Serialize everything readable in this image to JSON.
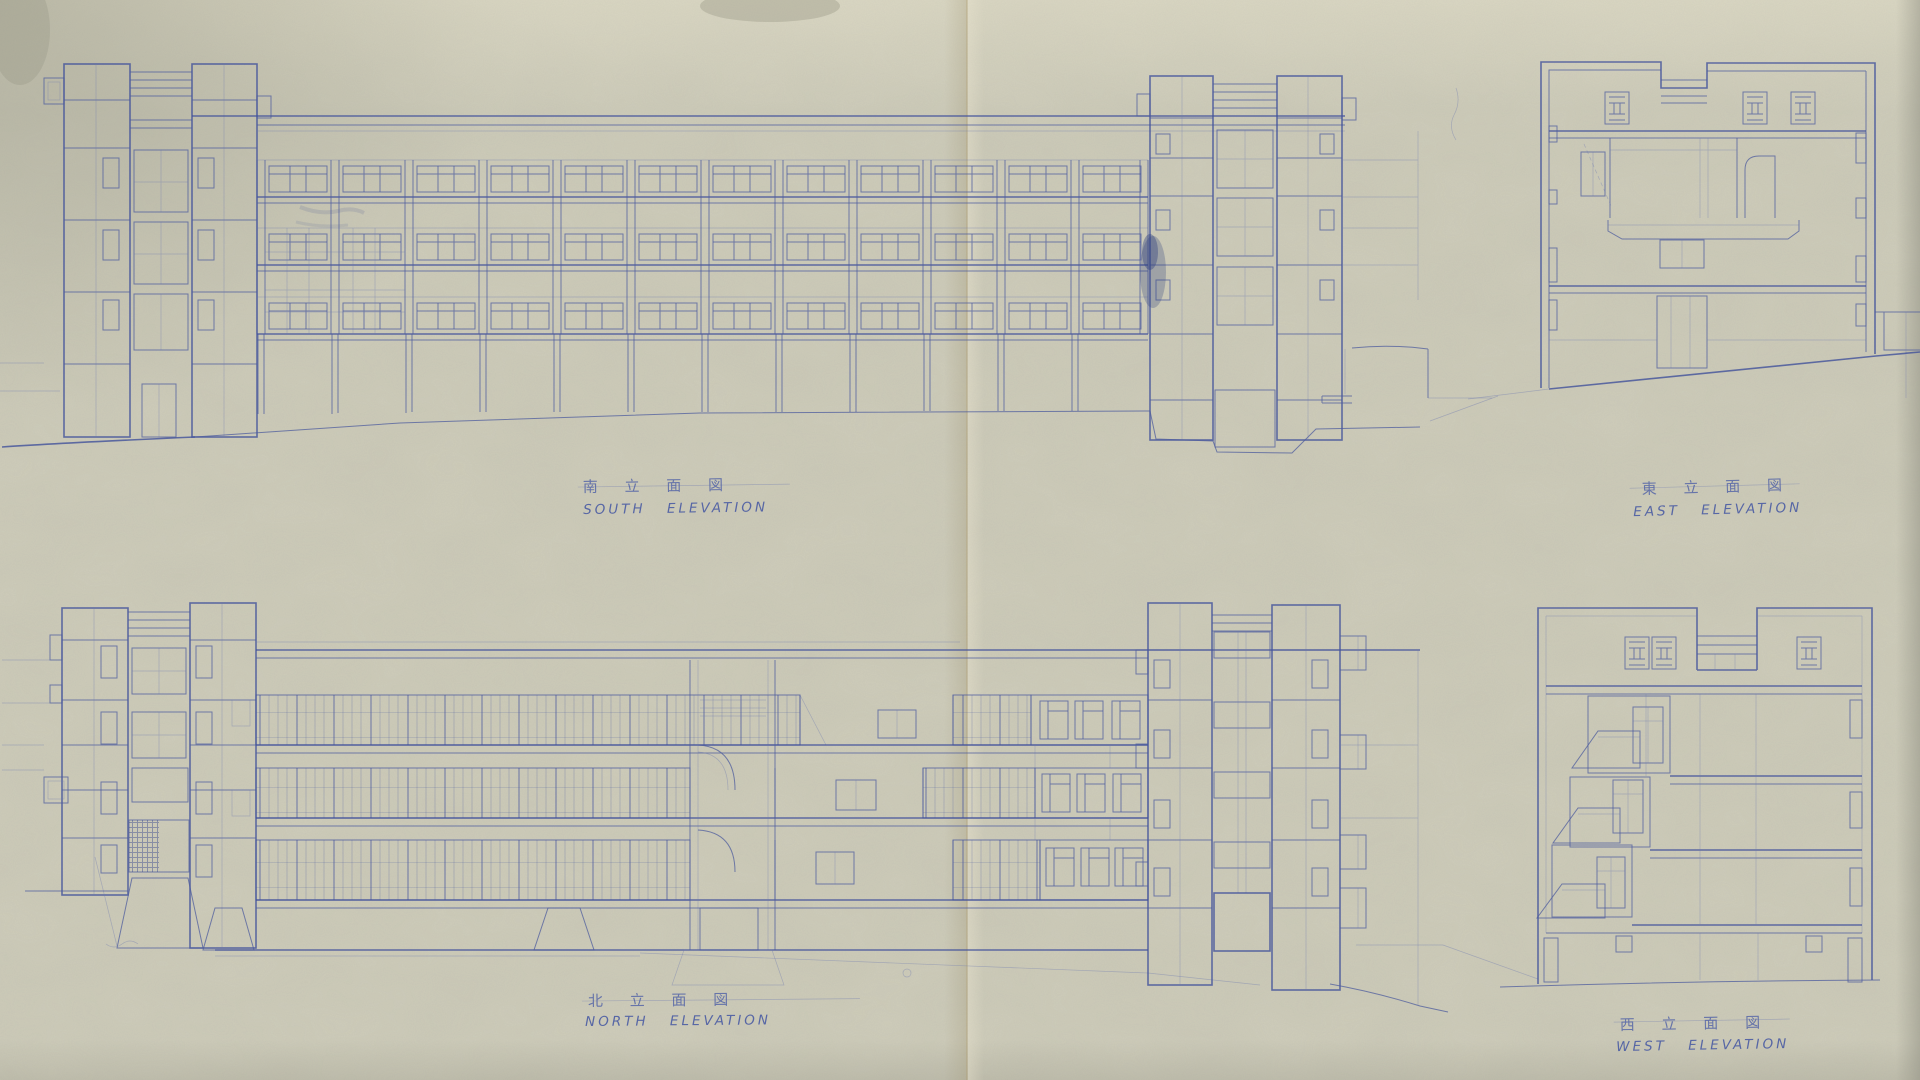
{
  "sheet": {
    "kind": "architectural blueprint, four building elevations, blue line on aged diazo paper"
  },
  "colors": {
    "paper": "#cfcdba",
    "paper_light": "#dcd9c6",
    "paper_shade": "#b2b19e",
    "ink": "#4d5c9e",
    "ink_heavy": "#35458c",
    "ink_faint": "#6d7ab0",
    "crease": "#b39b66"
  },
  "elevations": {
    "south": {
      "label_jp": "南 立 面 図",
      "label_en": "SOUTH ELEVATION"
    },
    "east": {
      "label_jp": "東 立 面 図",
      "label_en": "EAST ELEVATION"
    },
    "north": {
      "label_jp": "北 立 面 図",
      "label_en": "NORTH ELEVATION"
    },
    "west": {
      "label_jp": "西 立 面 図",
      "label_en": "WEST ELEVATION"
    }
  }
}
